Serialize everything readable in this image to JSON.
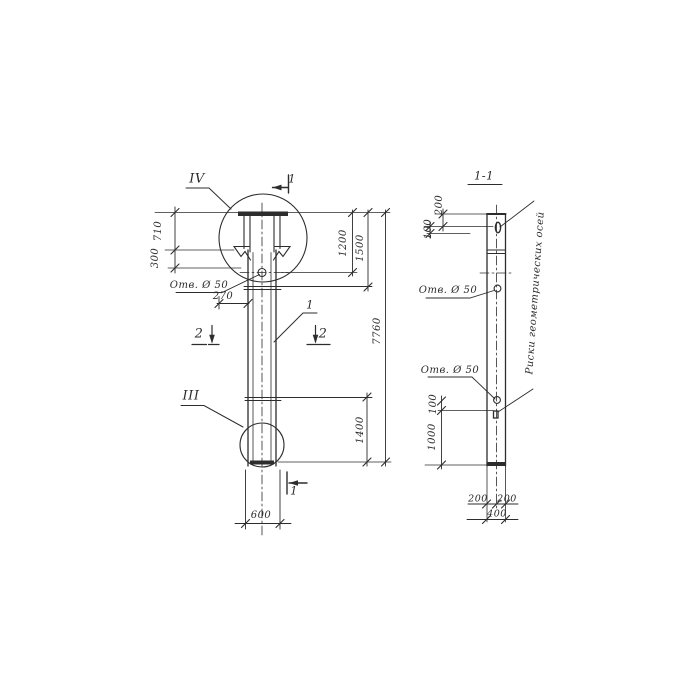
{
  "page": {
    "background": "#ffffff",
    "ink": "#2d2d2d"
  },
  "main_view": {
    "detail_top_label": "IV",
    "detail_bottom_label": "III",
    "part_label": "1",
    "section_cut_1_top": "1",
    "section_cut_1_bottom": "1",
    "section_cut_2_left": "2",
    "section_cut_2_right": "2",
    "hole_label": "Отв. Ø 50",
    "dims": {
      "d710": "710",
      "d300": "300",
      "d270": "270",
      "d1200": "1200",
      "d1500": "1500",
      "d7760": "7760",
      "d1400": "1400",
      "d600": "600"
    }
  },
  "section_view": {
    "title": "1-1",
    "hole_label_upper": "Отв. Ø 50",
    "hole_label_lower": "Отв. Ø 50",
    "axes_note": "Риски геометрических осей",
    "dims": {
      "d200_top": "200",
      "d100_top": "100",
      "d100_mid": "100",
      "d1000": "1000",
      "d200_left": "200",
      "d200_right": "200",
      "d400": "400"
    }
  }
}
